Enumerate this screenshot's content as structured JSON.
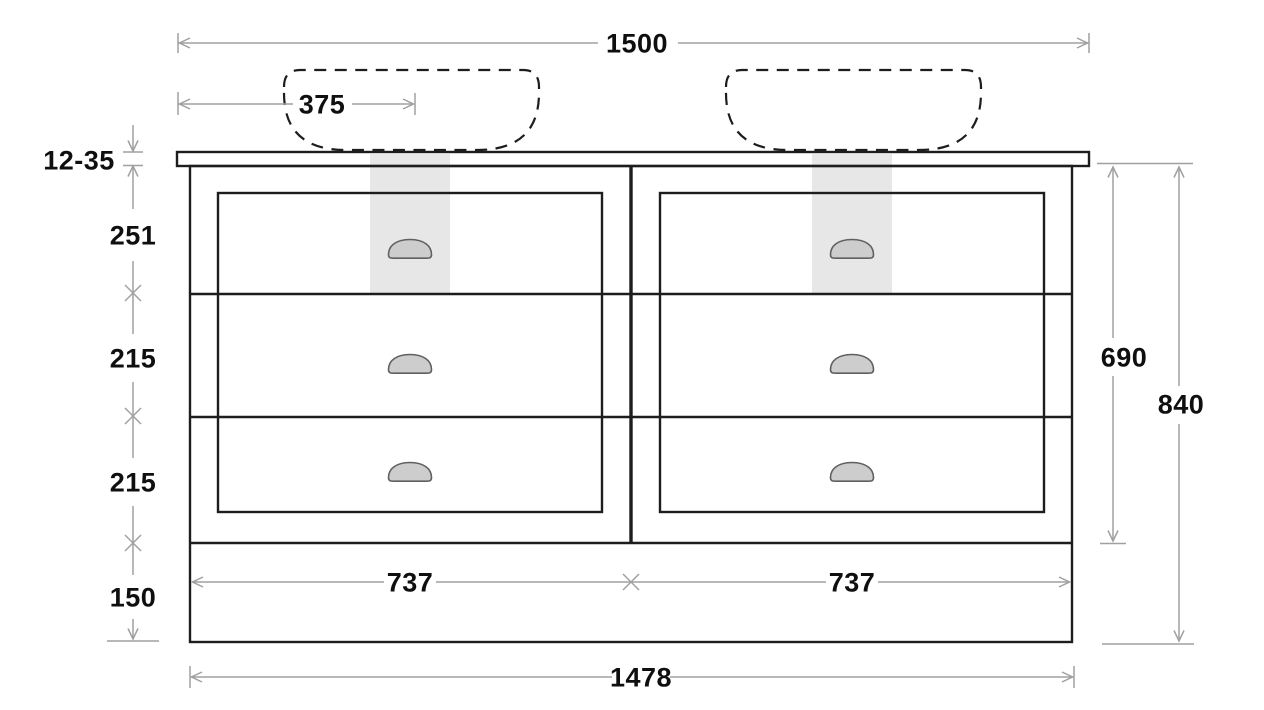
{
  "dimensions": {
    "countertop_width": "1500",
    "basin_center_offset": "375",
    "countertop_thickness": "12-35",
    "top_drawer_height": "251",
    "middle_drawer_height": "215",
    "bottom_drawer_height": "215",
    "plinth_height": "150",
    "carcass_height": "690",
    "overall_height": "840",
    "left_drawer_width": "737",
    "right_drawer_width": "737",
    "carcass_width": "1478"
  },
  "elements": {
    "basin_count": 2,
    "drawer_count": 6,
    "handle_count": 6
  },
  "colors": {
    "bg": "#ffffff",
    "ink": "#1d1d1d",
    "label": "#0f0f0f",
    "dim": "#a0a0a0",
    "bead": "#c9c9c9",
    "strip": "#e7e7e7",
    "handle_fill": "#cdcdcd",
    "handle_stroke": "#606060"
  }
}
